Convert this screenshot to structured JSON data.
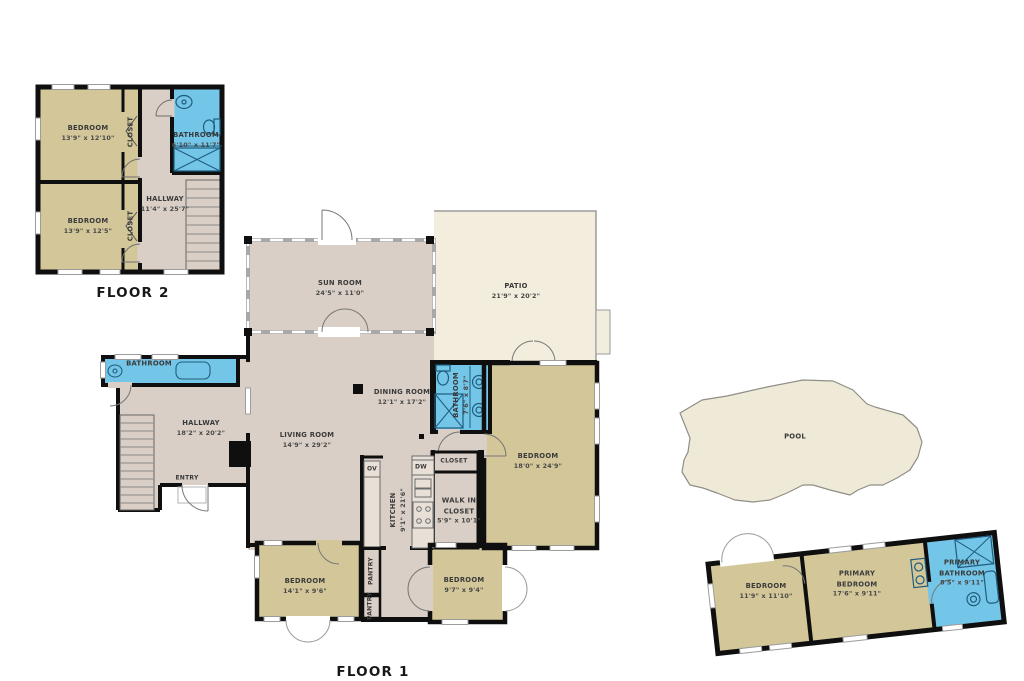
{
  "titles": {
    "floor2": "FLOOR 2",
    "floor1": "FLOOR 1"
  },
  "palette": {
    "bedroom_tan": "#d3c79a",
    "floor_taupe": "#d9cfc6",
    "bathroom_blue": "#74c6e8",
    "patio_cream": "#f3eddd",
    "pool_fill": "#efe9d8",
    "wall_black": "#0f0f0f"
  },
  "floor2": {
    "bedroom_top": {
      "name": "BEDROOM",
      "dims": "13'9\" x 12'10\""
    },
    "bedroom_bottom": {
      "name": "BEDROOM",
      "dims": "13'9\" x 12'5\""
    },
    "closet_top": {
      "name": "CLOSET"
    },
    "closet_bottom": {
      "name": "CLOSET"
    },
    "bathroom": {
      "name": "BATHROOM",
      "dims": "6'10\" x 11'7\""
    },
    "hallway": {
      "name": "HALLWAY",
      "dims": "11'4\" x 25'7\""
    }
  },
  "floor1": {
    "sun_room": {
      "name": "SUN ROOM",
      "dims": "24'5\" x 11'0\""
    },
    "patio": {
      "name": "PATIO",
      "dims": "21'9\" x 20'2\""
    },
    "dining_room": {
      "name": "DINING ROOM",
      "dims": "12'1\" x 17'2\""
    },
    "living_room": {
      "name": "LIVING ROOM",
      "dims": "14'9\" x 29'2\""
    },
    "hallway": {
      "name": "HALLWAY",
      "dims": "18'2\" x 20'2\""
    },
    "bathroom_small": {
      "name": "BATHROOM"
    },
    "entry": {
      "name": "ENTRY"
    },
    "bathroom_mid": {
      "name": "BATHROOM",
      "dims": "7'6\" x 8'7\""
    },
    "bedroom_right": {
      "name": "BEDROOM",
      "dims": "18'0\" x 24'9\""
    },
    "kitchen": {
      "name": "KITCHEN",
      "dims": "9'1\" x 21'6\""
    },
    "ov": "OV",
    "dw": "DW",
    "closet": {
      "name": "CLOSET"
    },
    "walk_in_closet": {
      "name": "WALK IN",
      "name2": "CLOSET",
      "dims": "5'9\" x 10'1\""
    },
    "bedroom_bottom_left": {
      "name": "BEDROOM",
      "dims": "14'1\" x 9'6\""
    },
    "pantry_top": {
      "name": "PANTRY"
    },
    "pantry_bottom": {
      "name": "PANTRY"
    },
    "bedroom_bottom_mid": {
      "name": "BEDROOM",
      "dims": "9'7\" x 9'4\""
    }
  },
  "exterior": {
    "pool": {
      "name": "POOL"
    }
  },
  "guest_house": {
    "bedroom": {
      "name": "BEDROOM",
      "dims": "11'9\" x 11'10\""
    },
    "primary_bedroom": {
      "name": "PRIMARY",
      "name2": "BEDROOM",
      "dims": "17'6\" x 9'11\""
    },
    "primary_bathroom": {
      "name": "PRIMARY",
      "name2": "BATHROOM",
      "dims": "8'5\" x 9'11\""
    }
  }
}
